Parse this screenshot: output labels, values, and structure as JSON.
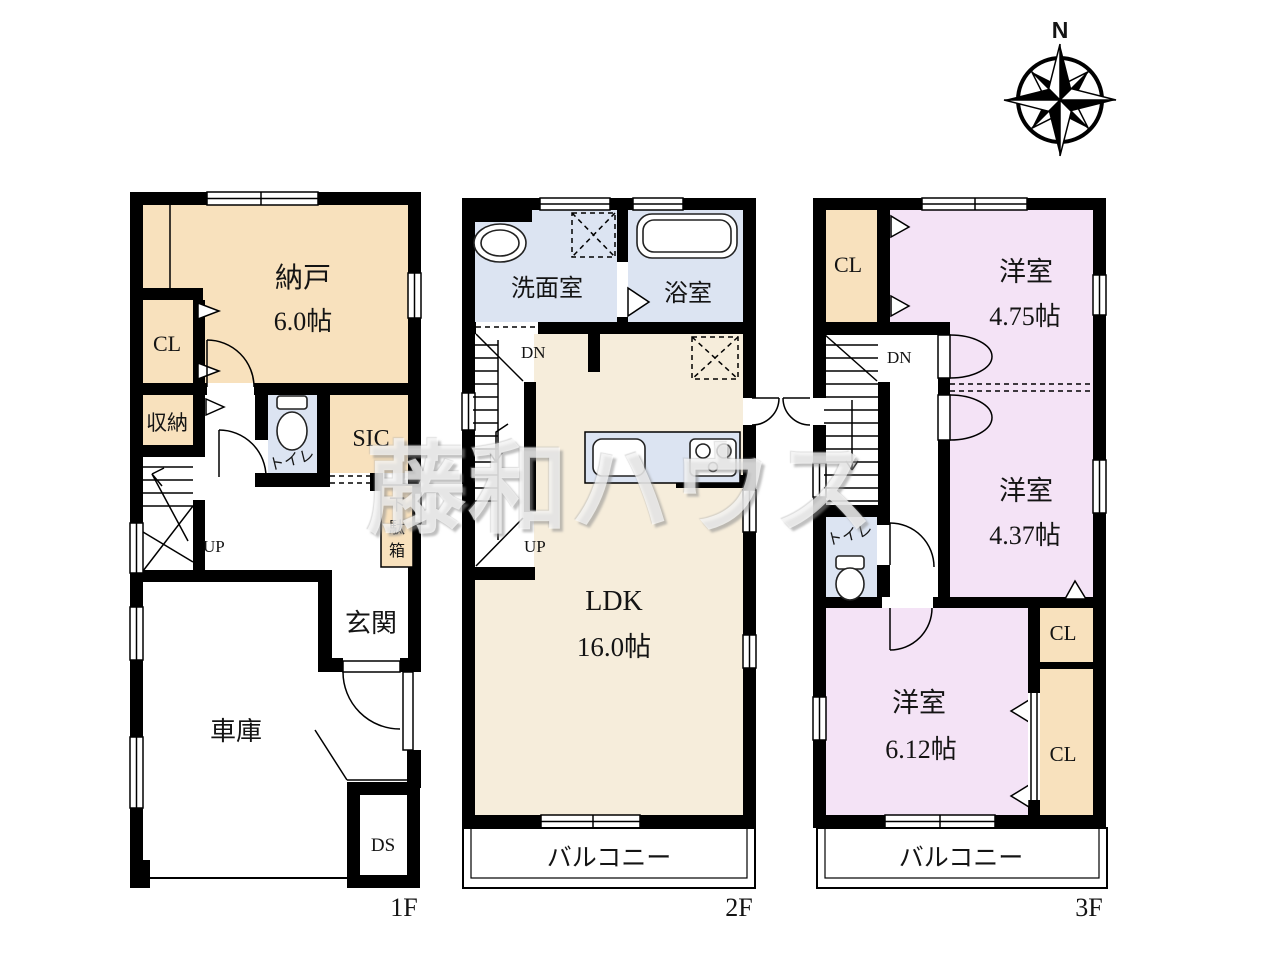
{
  "colors": {
    "tan": "#f8e1bd",
    "blue": "#dce4f2",
    "cream": "#f6eddb",
    "pink": "#f4e3f6",
    "wall": "#000000"
  },
  "compass": {
    "north_label": "N"
  },
  "watermark": {
    "text": "藤和ハウス"
  },
  "floor1": {
    "label": "1F",
    "storage_room": "納戸",
    "storage_room_size": "6.0帖",
    "closet": "CL",
    "shuno": "収納",
    "toilet": "トイレ",
    "sic": "SIC",
    "getabako_chars": [
      "下",
      "駄",
      "箱"
    ],
    "up": "UP",
    "entrance": "玄関",
    "garage": "車庫",
    "duct": "DS"
  },
  "floor2": {
    "label": "2F",
    "washroom": "洗面室",
    "bathroom": "浴室",
    "down": "DN",
    "up": "UP",
    "ldk": "LDK",
    "ldk_size": "16.0帖",
    "balcony": "バルコニー"
  },
  "floor3": {
    "label": "3F",
    "closet_a": "CL",
    "room_a": "洋室",
    "room_a_size": "4.75帖",
    "down": "DN",
    "room_b": "洋室",
    "room_b_size": "4.37帖",
    "toilet": "トイレ",
    "room_c": "洋室",
    "room_c_size": "6.12帖",
    "closet_b": "CL",
    "closet_c": "CL",
    "balcony": "バルコニー"
  }
}
